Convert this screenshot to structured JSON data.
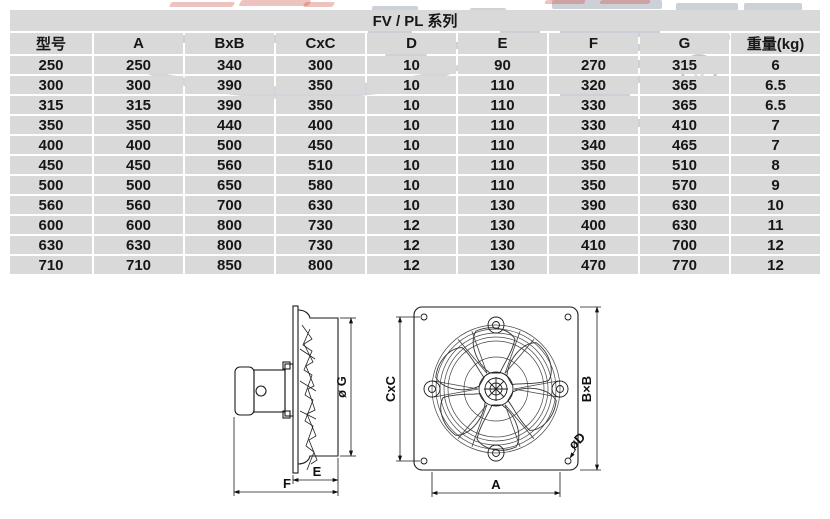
{
  "title": "FV / PL 系列",
  "table": {
    "columns": [
      "型号",
      "A",
      "BxB",
      "CxC",
      "D",
      "E",
      "F",
      "G",
      "重量(kg)"
    ],
    "rows": [
      [
        "250",
        "250",
        "340",
        "300",
        "10",
        "90",
        "270",
        "315",
        "6"
      ],
      [
        "300",
        "300",
        "390",
        "350",
        "10",
        "110",
        "320",
        "365",
        "6.5"
      ],
      [
        "315",
        "315",
        "390",
        "350",
        "10",
        "110",
        "330",
        "365",
        "6.5"
      ],
      [
        "350",
        "350",
        "440",
        "400",
        "10",
        "110",
        "330",
        "410",
        "7"
      ],
      [
        "400",
        "400",
        "500",
        "450",
        "10",
        "110",
        "340",
        "465",
        "7"
      ],
      [
        "450",
        "450",
        "560",
        "510",
        "10",
        "110",
        "350",
        "510",
        "8"
      ],
      [
        "500",
        "500",
        "650",
        "580",
        "10",
        "110",
        "350",
        "570",
        "9"
      ],
      [
        "560",
        "560",
        "700",
        "630",
        "10",
        "130",
        "390",
        "630",
        "10"
      ],
      [
        "600",
        "600",
        "800",
        "730",
        "12",
        "130",
        "400",
        "630",
        "11"
      ],
      [
        "630",
        "630",
        "800",
        "730",
        "12",
        "130",
        "410",
        "700",
        "12"
      ],
      [
        "710",
        "710",
        "850",
        "800",
        "12",
        "130",
        "470",
        "770",
        "12"
      ]
    ]
  },
  "diagram": {
    "side_view": {
      "dim_g": "ø G",
      "dim_e": "E",
      "dim_f": "F"
    },
    "front_view": {
      "dim_cxc": "CxC",
      "dim_bxb": "B×B",
      "dim_a": "A",
      "dim_d": "øD"
    }
  },
  "watermark": {
    "registered": "®"
  }
}
